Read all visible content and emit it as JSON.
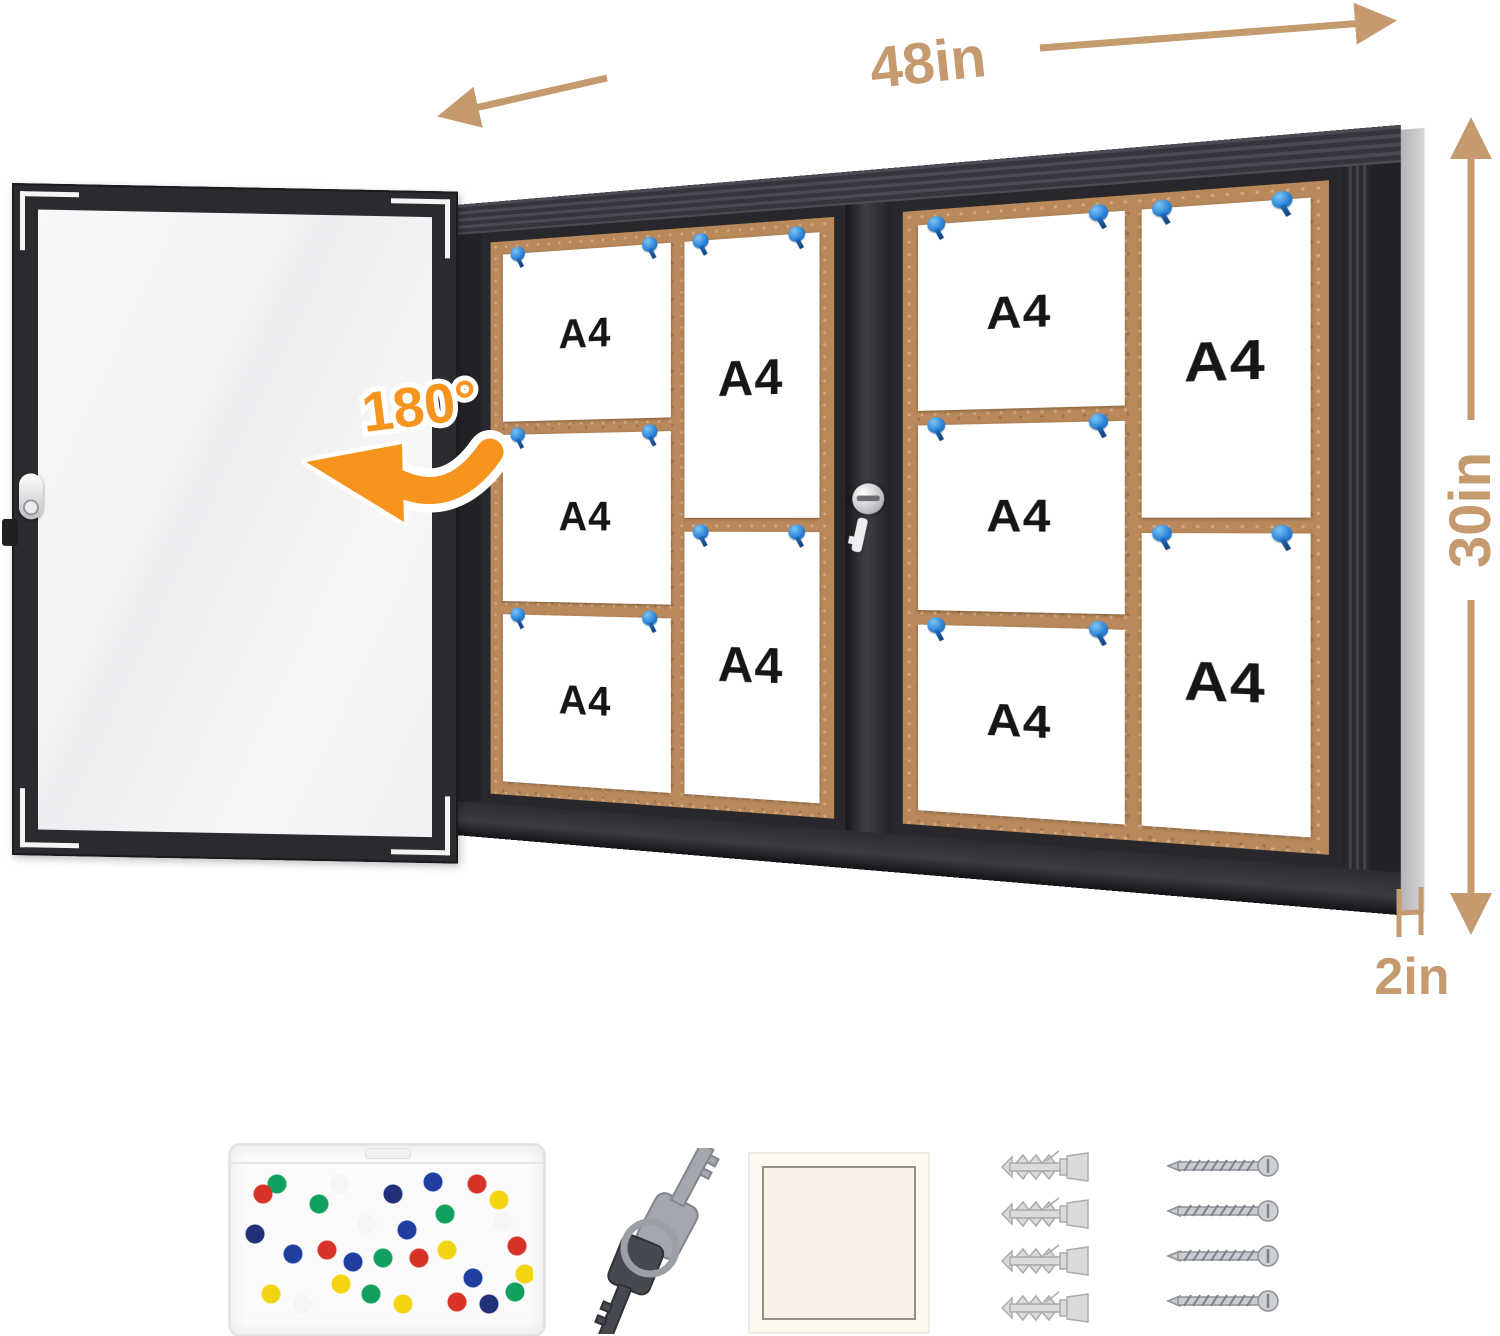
{
  "annotations": {
    "width_label": "48in",
    "height_label": "30in",
    "depth_label": "2in",
    "door_rotation_label": "180°"
  },
  "board": {
    "paper_label": "A4",
    "paper_count": 10,
    "sections": 2,
    "papers_per_section": {
      "landscape": 3,
      "portrait": 2
    },
    "pin_color": "#2e86d9",
    "cork_color": "#b9895c",
    "frame_color": "#232327",
    "glass_door_color": "#f4f4f6"
  },
  "annotation_colors": {
    "dimension": "#c49a6e",
    "rotation": "#f7941d",
    "background": "#ffffff"
  },
  "accessories": {
    "pin_box": {
      "name": "push-pin-box",
      "pin_colors": [
        "#d63226",
        "#1e3fa0",
        "#12a05f",
        "#f3d410",
        "#f5f5f5",
        "#22307a"
      ]
    },
    "keys": {
      "name": "lock-keys",
      "count": 2
    },
    "tile": {
      "name": "white-square-tile"
    },
    "anchors": {
      "name": "wall-anchors",
      "count": 4
    },
    "screws": {
      "name": "mounting-screws",
      "count": 4
    }
  }
}
